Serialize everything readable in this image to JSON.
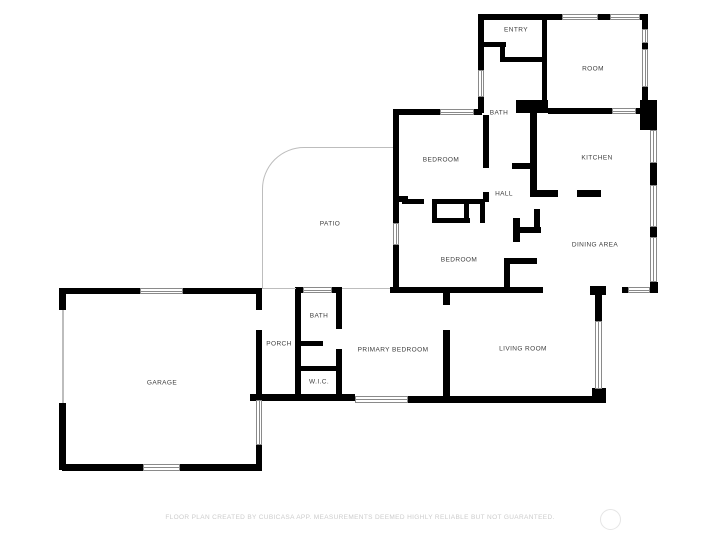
{
  "footer": {
    "disclaimer": "FLOOR PLAN CREATED BY CUBICASA APP. MEASUREMENTS DEEMED HIGHLY RELIABLE BUT NOT GUARANTEED."
  },
  "colors": {
    "background": "#ffffff",
    "wall": "#000000",
    "window_frame": "#8a8a8a",
    "thin_line": "#bdbdbd",
    "label_text": "#3d3d3d",
    "footer_text": "#cccccc"
  },
  "floorplan": {
    "rooms": [
      {
        "name": "entry",
        "label": "ENTRY",
        "x": 516,
        "y": 30
      },
      {
        "name": "room",
        "label": "ROOM",
        "x": 593,
        "y": 69
      },
      {
        "name": "bath-upper",
        "label": "BATH",
        "x": 499,
        "y": 113
      },
      {
        "name": "bedroom-upper",
        "label": "BEDROOM",
        "x": 441,
        "y": 160
      },
      {
        "name": "kitchen",
        "label": "KITCHEN",
        "x": 597,
        "y": 158
      },
      {
        "name": "hall",
        "label": "HALL",
        "x": 504,
        "y": 194
      },
      {
        "name": "patio",
        "label": "PATIO",
        "x": 330,
        "y": 224
      },
      {
        "name": "dining-area",
        "label": "DINING AREA",
        "x": 595,
        "y": 245
      },
      {
        "name": "bedroom-lower",
        "label": "BEDROOM",
        "x": 459,
        "y": 260
      },
      {
        "name": "bath-lower",
        "label": "BATH",
        "x": 319,
        "y": 316
      },
      {
        "name": "porch",
        "label": "PORCH",
        "x": 279,
        "y": 344
      },
      {
        "name": "primary-bedroom",
        "label": "PRIMARY BEDROOM",
        "x": 393,
        "y": 350
      },
      {
        "name": "living-room",
        "label": "LIVING ROOM",
        "x": 523,
        "y": 349
      },
      {
        "name": "wic",
        "label": "W.I.C.",
        "x": 319,
        "y": 382
      },
      {
        "name": "garage",
        "label": "GARAGE",
        "x": 162,
        "y": 383
      }
    ],
    "walls": [
      [
        478,
        14,
        86,
        6
      ],
      [
        598,
        14,
        14,
        6
      ],
      [
        638,
        14,
        10,
        6
      ],
      [
        478,
        14,
        6,
        56
      ],
      [
        478,
        97,
        6,
        16
      ],
      [
        542,
        14,
        5,
        98
      ],
      [
        642,
        14,
        6,
        15
      ],
      [
        642,
        43,
        6,
        6
      ],
      [
        642,
        87,
        6,
        26
      ],
      [
        478,
        42,
        28,
        5
      ],
      [
        500,
        42,
        5,
        20
      ],
      [
        500,
        57,
        47,
        5
      ],
      [
        516,
        100,
        32,
        13
      ],
      [
        548,
        108,
        64,
        6
      ],
      [
        636,
        108,
        12,
        6
      ],
      [
        640,
        100,
        17,
        30
      ],
      [
        393,
        109,
        47,
        6
      ],
      [
        474,
        109,
        8,
        6
      ],
      [
        393,
        109,
        6,
        114
      ],
      [
        393,
        245,
        6,
        48
      ],
      [
        399,
        196,
        9,
        6
      ],
      [
        483,
        115,
        6,
        53
      ],
      [
        483,
        192,
        6,
        10
      ],
      [
        530,
        113,
        7,
        80
      ],
      [
        512,
        163,
        18,
        6
      ],
      [
        530,
        190,
        28,
        7
      ],
      [
        577,
        190,
        24,
        7
      ],
      [
        402,
        199,
        22,
        5
      ],
      [
        432,
        199,
        53,
        5
      ],
      [
        432,
        199,
        5,
        24
      ],
      [
        464,
        199,
        5,
        24
      ],
      [
        432,
        218,
        38,
        5
      ],
      [
        480,
        199,
        5,
        24
      ],
      [
        517,
        227,
        24,
        6
      ],
      [
        534,
        209,
        6,
        24
      ],
      [
        504,
        258,
        33,
        6
      ],
      [
        504,
        258,
        6,
        32
      ],
      [
        513,
        218,
        7,
        24
      ],
      [
        390,
        287,
        153,
        6
      ],
      [
        590,
        286,
        16,
        9
      ],
      [
        595,
        295,
        7,
        26
      ],
      [
        622,
        287,
        6,
        6
      ],
      [
        650,
        282,
        8,
        11
      ],
      [
        650,
        163,
        7,
        22
      ],
      [
        650,
        227,
        7,
        10
      ],
      [
        295,
        287,
        8,
        6
      ],
      [
        332,
        287,
        10,
        6
      ],
      [
        295,
        287,
        6,
        113
      ],
      [
        336,
        287,
        6,
        42
      ],
      [
        336,
        349,
        6,
        51
      ],
      [
        300,
        341,
        23,
        5
      ],
      [
        300,
        366,
        42,
        5
      ],
      [
        443,
        291,
        7,
        14
      ],
      [
        443,
        330,
        7,
        70
      ],
      [
        250,
        394,
        105,
        7
      ],
      [
        408,
        396,
        190,
        7
      ],
      [
        592,
        388,
        14,
        15
      ],
      [
        62,
        288,
        78,
        6
      ],
      [
        183,
        288,
        79,
        6
      ],
      [
        59,
        288,
        7,
        22
      ],
      [
        59,
        403,
        7,
        67
      ],
      [
        62,
        464,
        81,
        7
      ],
      [
        180,
        464,
        82,
        7
      ],
      [
        256,
        288,
        6,
        22
      ],
      [
        256,
        330,
        6,
        70
      ],
      [
        256,
        445,
        6,
        25
      ]
    ],
    "windows": [
      {
        "x": 562,
        "y": 14,
        "w": 36,
        "h": 6,
        "o": "h"
      },
      {
        "x": 610,
        "y": 14,
        "w": 30,
        "h": 6,
        "o": "h"
      },
      {
        "x": 440,
        "y": 109,
        "w": 34,
        "h": 6,
        "o": "h"
      },
      {
        "x": 612,
        "y": 108,
        "w": 24,
        "h": 6,
        "o": "h"
      },
      {
        "x": 140,
        "y": 288,
        "w": 43,
        "h": 6,
        "o": "h"
      },
      {
        "x": 303,
        "y": 287,
        "w": 29,
        "h": 6,
        "o": "h"
      },
      {
        "x": 143,
        "y": 464,
        "w": 37,
        "h": 7,
        "o": "h"
      },
      {
        "x": 355,
        "y": 396,
        "w": 53,
        "h": 7,
        "o": "h"
      },
      {
        "x": 628,
        "y": 287,
        "w": 22,
        "h": 6,
        "o": "h"
      },
      {
        "x": 478,
        "y": 70,
        "w": 6,
        "h": 27,
        "o": "v"
      },
      {
        "x": 642,
        "y": 29,
        "w": 6,
        "h": 14,
        "o": "v"
      },
      {
        "x": 642,
        "y": 49,
        "w": 6,
        "h": 38,
        "o": "v"
      },
      {
        "x": 393,
        "y": 223,
        "w": 6,
        "h": 22,
        "o": "v"
      },
      {
        "x": 650,
        "y": 130,
        "w": 7,
        "h": 33,
        "o": "v"
      },
      {
        "x": 650,
        "y": 185,
        "w": 7,
        "h": 42,
        "o": "v"
      },
      {
        "x": 650,
        "y": 237,
        "w": 7,
        "h": 45,
        "o": "v"
      },
      {
        "x": 595,
        "y": 321,
        "w": 7,
        "h": 68,
        "o": "v"
      },
      {
        "x": 256,
        "y": 400,
        "w": 6,
        "h": 45,
        "o": "v"
      }
    ],
    "thin_lines": [
      {
        "name": "garage-door-line",
        "x": 62,
        "y": 310,
        "w": 2,
        "h": 93
      },
      {
        "name": "porch-top-line",
        "x": 262,
        "y": 288,
        "w": 34,
        "h": 1
      }
    ],
    "patio_outline": {
      "x": 262,
      "y": 147,
      "w": 137,
      "h": 142,
      "radius": 42
    },
    "watermark": {
      "x": 600,
      "y": 509,
      "d": 21
    }
  }
}
